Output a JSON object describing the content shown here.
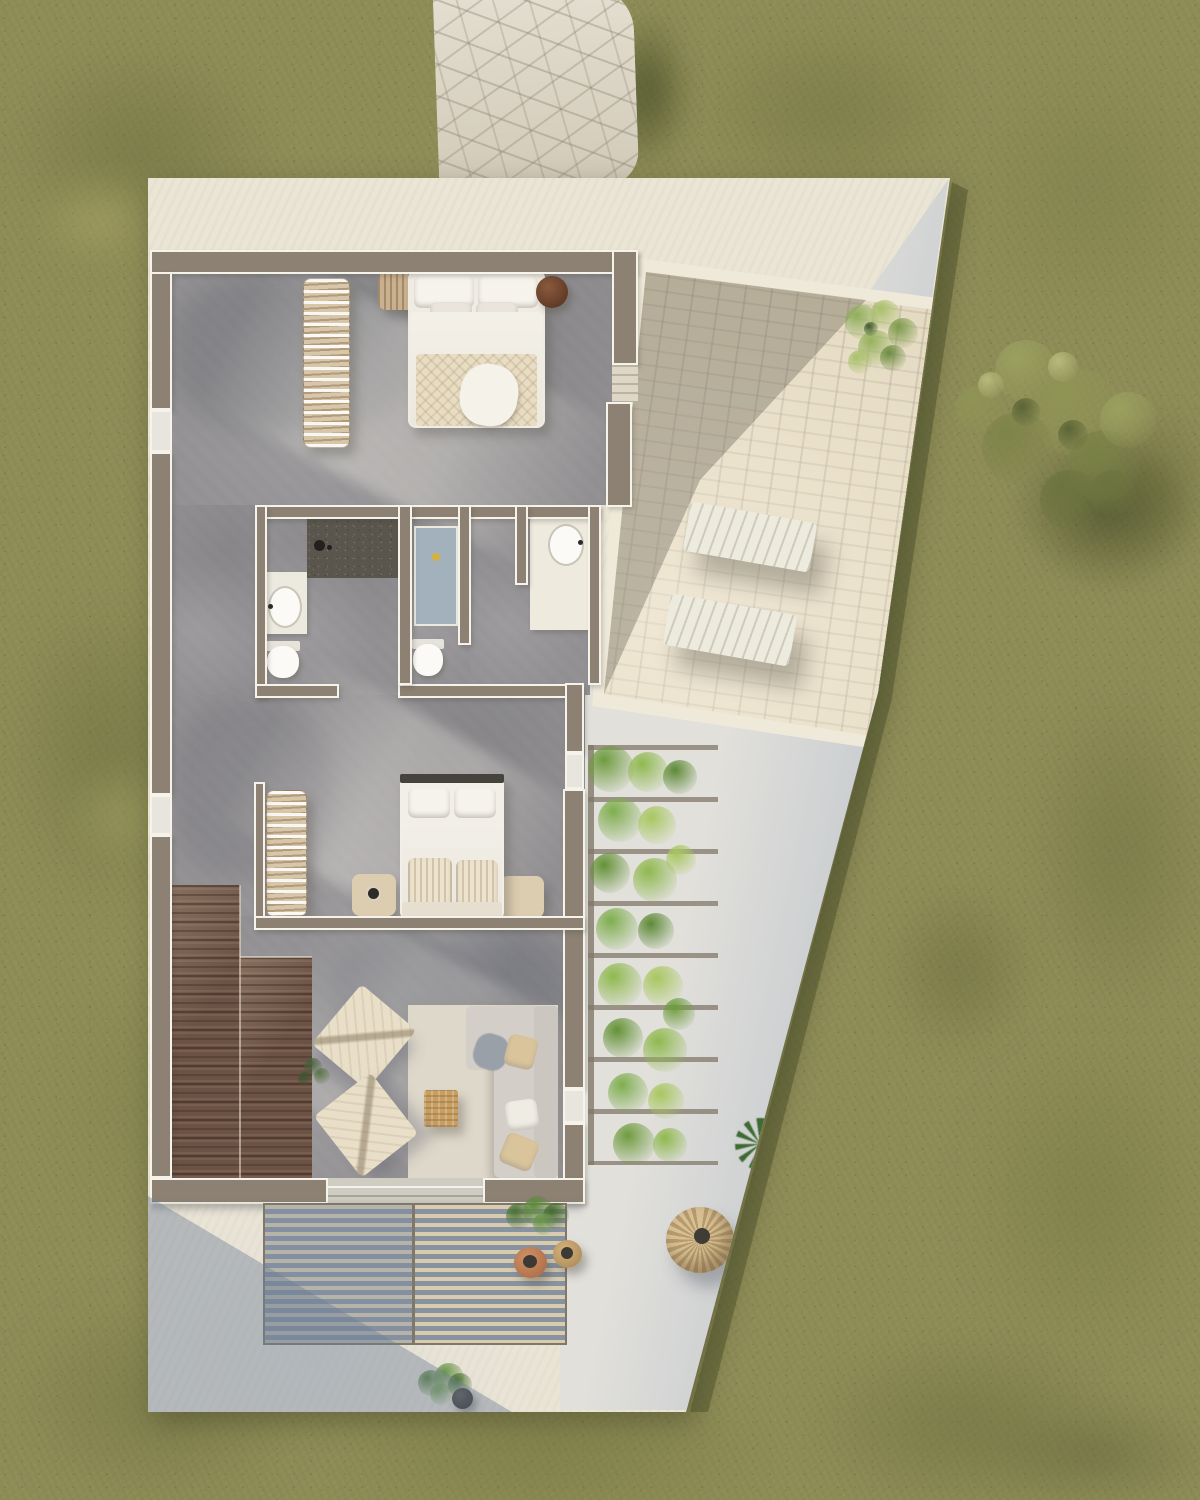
{
  "scene": {
    "kind": "3d-architectural-site-plan-render",
    "view": "top-down aerial",
    "visible_text": "none",
    "lighting": "sunlight from upper-left with long diagonal shadows"
  },
  "palette": {
    "grass": "#8e8c57",
    "grass_dark": "#6c6e3d",
    "grass_light": "#b2ae74",
    "path": "#d6cfbe",
    "paving": "#ebe5d5",
    "wall": "#8c8172",
    "wall_outline": "#f6f3ea",
    "floor": "#939193",
    "stone": "#ddd1b5",
    "stone_border": "#efe9da",
    "concrete": "#b4bcc7",
    "slat": "#d8cbae",
    "wood": "#6b5244",
    "rug": "#ded8ca",
    "sofa": "#cbc7c0",
    "white_furniture": "#f2efe7",
    "cushion": "#d9c49c",
    "shower_blue": "#a3b1bd",
    "drain": "#d4b23c",
    "vine": "#7fae4e",
    "tree": "#8f9455",
    "parasol_a": "#d8c094",
    "parasol_b": "#b79b6d",
    "table_wood": "#c79f63",
    "pot_dark": "#3a3733"
  },
  "areas": {
    "garden": {
      "label": "lawn",
      "features": [
        "mottled olive grass",
        "large tree with cast shadow"
      ]
    },
    "entrance_path": {
      "label": "flagstone path",
      "position": "top center"
    },
    "plot": {
      "label": "paved property plot",
      "shape": "irregular polygon with slanted right edge"
    },
    "patio": {
      "label": "stone front patio",
      "items": [
        "leafy potted plant",
        "sun lounger",
        "sun lounger"
      ]
    },
    "courtyard": {
      "label": "shaded concrete side courtyard",
      "items": [
        "vine pergola",
        "agave plant",
        "rattan parasol"
      ]
    },
    "deck": {
      "label": "slatted timber deck",
      "items": [
        "fan plant",
        "terracotta pouf",
        "rattan pouf"
      ]
    },
    "house": {
      "rooms": [
        {
          "name": "bedroom-1",
          "furniture": [
            "double bed with white bedding",
            "open wardrobe rack",
            "ribbed dresser",
            "round dark-wood side table"
          ]
        },
        {
          "name": "bathroom-1",
          "fixtures": [
            "dark mosaic shower",
            "oval washbasin on counter",
            "toilet"
          ]
        },
        {
          "name": "shower-room",
          "fixtures": [
            "blue shower tray with drain",
            "toilet"
          ]
        },
        {
          "name": "vanity-room",
          "fixtures": [
            "washbasin counter"
          ]
        },
        {
          "name": "bedroom-2",
          "furniture": [
            "double bed with dark headboard",
            "open wardrobe rack",
            "nightstand with cup",
            "nightstand"
          ]
        },
        {
          "name": "living-room",
          "furniture": [
            "sectional sofa with cushions",
            "cream rug",
            "woven cube coffee table",
            "two slatted lounge chairs",
            "small indoor plant"
          ]
        },
        {
          "name": "stairs",
          "furniture": [
            "dark timber stepped deck"
          ]
        }
      ],
      "openings": [
        "left window 1",
        "left window 2",
        "patio door with steps",
        "right window 1",
        "right window 2",
        "terrace sliding door"
      ]
    },
    "landscape_items": [
      "tree",
      "tree shadow",
      "potted plant with dark pot at bottom",
      "dark shadow band along plot edge"
    ]
  }
}
